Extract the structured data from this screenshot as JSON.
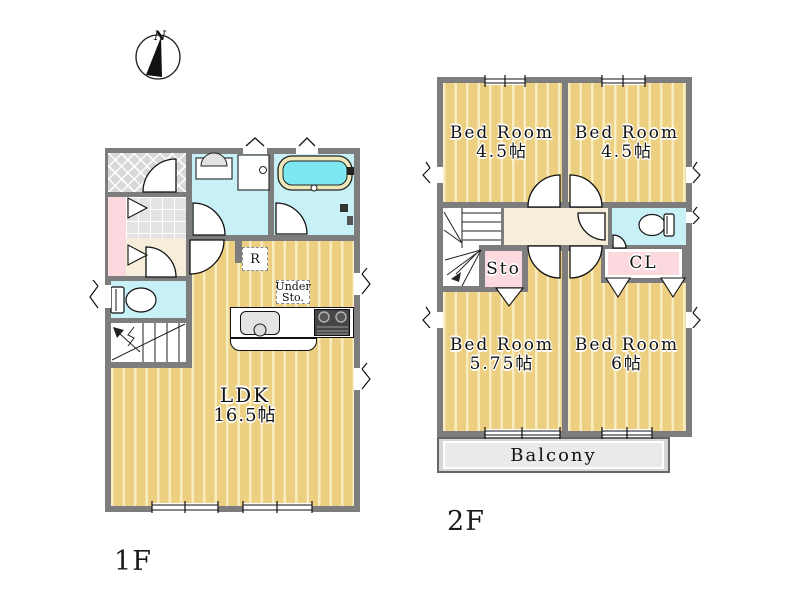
{
  "colors": {
    "wall": "#7d7d7d",
    "floor": "#eccf80",
    "stripe": "#f8ecc3",
    "water": "#c7f1f7",
    "tub": "#7de8f2",
    "pink": "#fbd9de",
    "hall": "#f6eedb",
    "tile": "#e3e3e3",
    "porch": "#d8d8d8",
    "balcony": "#eaeaea",
    "balcony-band": "#d6d6d6"
  },
  "compass": {
    "label": "N"
  },
  "floor1": {
    "name": "1F",
    "ldk_label": {
      "line1": "LDK",
      "line2": "16.5帖"
    },
    "refrigerator_label": "R",
    "under_storage_label": {
      "line1": "Under",
      "line2": "Sto."
    }
  },
  "floor2": {
    "name": "2F",
    "bedroom_top_left": {
      "line1": "Bed Room",
      "line2": "4.5帖"
    },
    "bedroom_top_right": {
      "line1": "Bed Room",
      "line2": "4.5帖"
    },
    "bedroom_bottom_left": {
      "line1": "Bed Room",
      "line2": "5.75帖"
    },
    "bedroom_bottom_right": {
      "line1": "Bed Room",
      "line2": "6帖"
    },
    "storage_label": "Sto",
    "closet_label": "CL",
    "balcony_label": "Balcony"
  }
}
